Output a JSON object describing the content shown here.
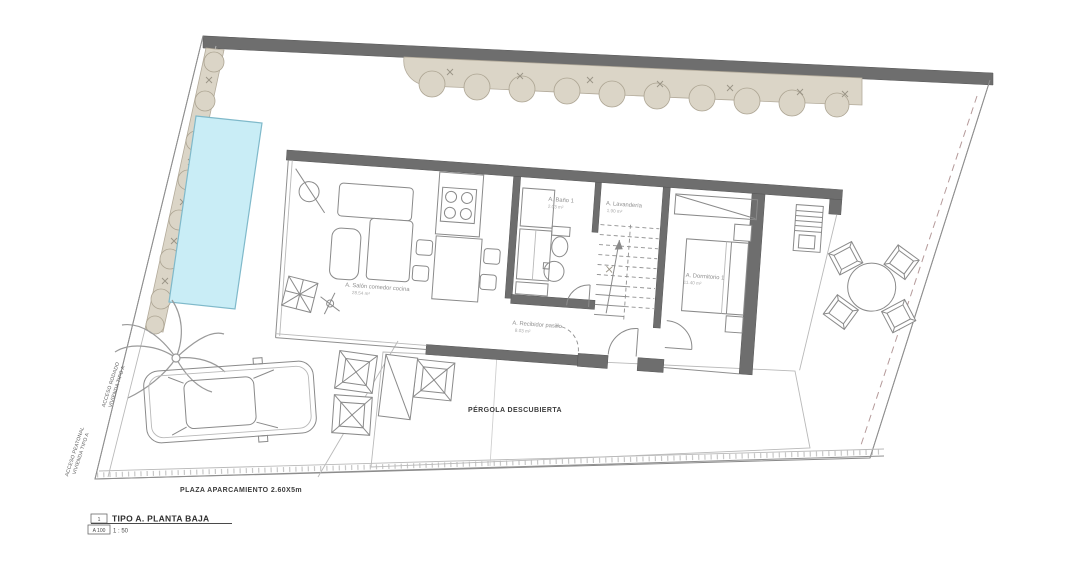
{
  "plan": {
    "sheet": {
      "number": "1",
      "code": "A 100",
      "title": "TIPO A. PLANTA BAJA",
      "scale": "1 : 50"
    },
    "rooms": {
      "salon": {
        "name": "A. Salón comedor cocina",
        "area": "28.54 m²"
      },
      "bano": {
        "name": "A. Baño 1",
        "area": "2.03 m²"
      },
      "lavanderia": {
        "name": "A. Lavandería",
        "area": "1.90 m²"
      },
      "dormitorio": {
        "name": "A. Dormitorio 1",
        "area": "11.40 m²"
      },
      "recibidor": {
        "name": "A. Recibidor pasillo",
        "area": "8.03 m²"
      }
    },
    "site": {
      "pergola": "PÉRGOLA DESCUBIERTA",
      "parking": "PLAZA APARCAMIENTO 2.60X5m",
      "access_road_line1": "ACCESO RODADO",
      "access_road_line2": "VIVIENDA TIPO A",
      "access_ped_line1": "ACCESO PEATONAL",
      "access_ped_line2": "VIVIENDA TIPO A"
    },
    "colors": {
      "wall": "#6e6e6e",
      "hedge": "#dbd5c7",
      "pool": "#c9edf6",
      "line": "#8f8f8f"
    }
  }
}
